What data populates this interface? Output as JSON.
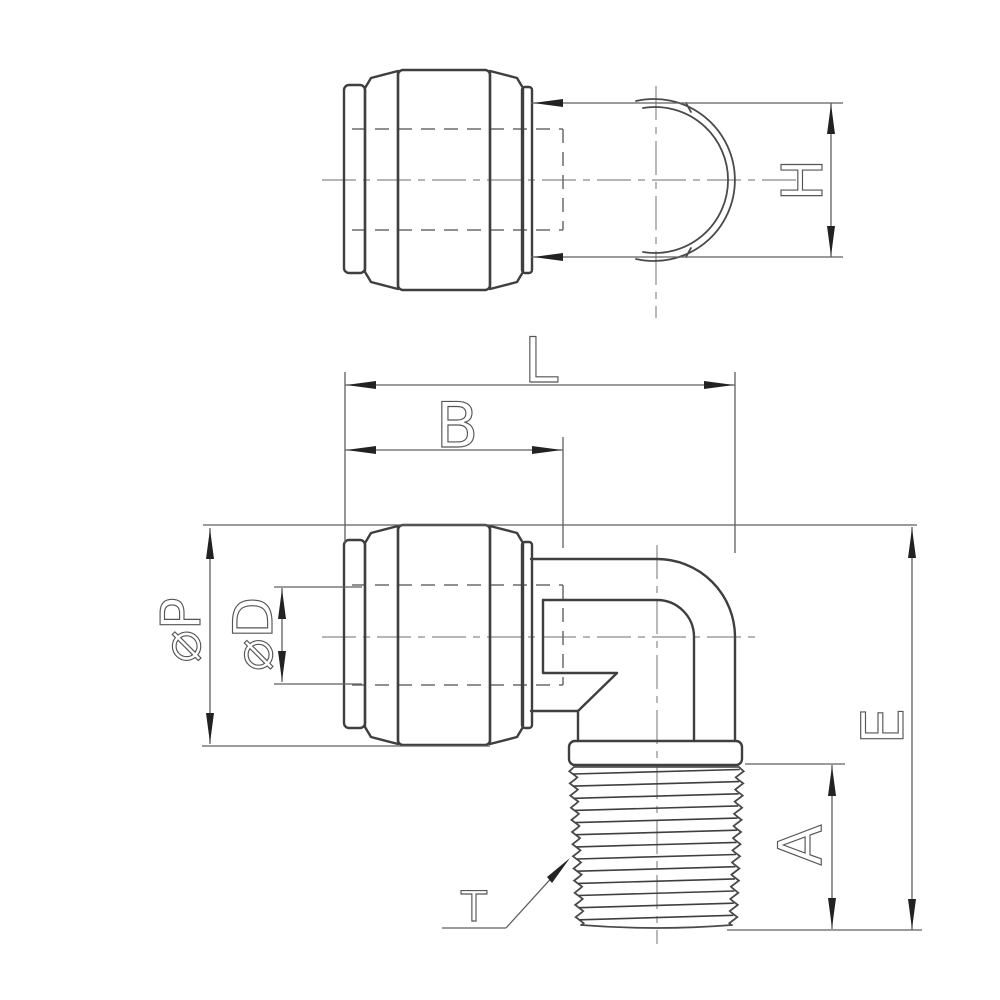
{
  "labels": {
    "overall_length": "L",
    "insertion_depth": "B",
    "elbow_height": "H",
    "body_diameter": "⌀P",
    "bore_diameter": "⌀D",
    "overall_height": "E",
    "thread_length": "A",
    "thread_callout": "T"
  },
  "colors": {
    "object_line": "#3f3f3f",
    "dimension_line": "#5f5f5f",
    "background": "#ffffff"
  }
}
